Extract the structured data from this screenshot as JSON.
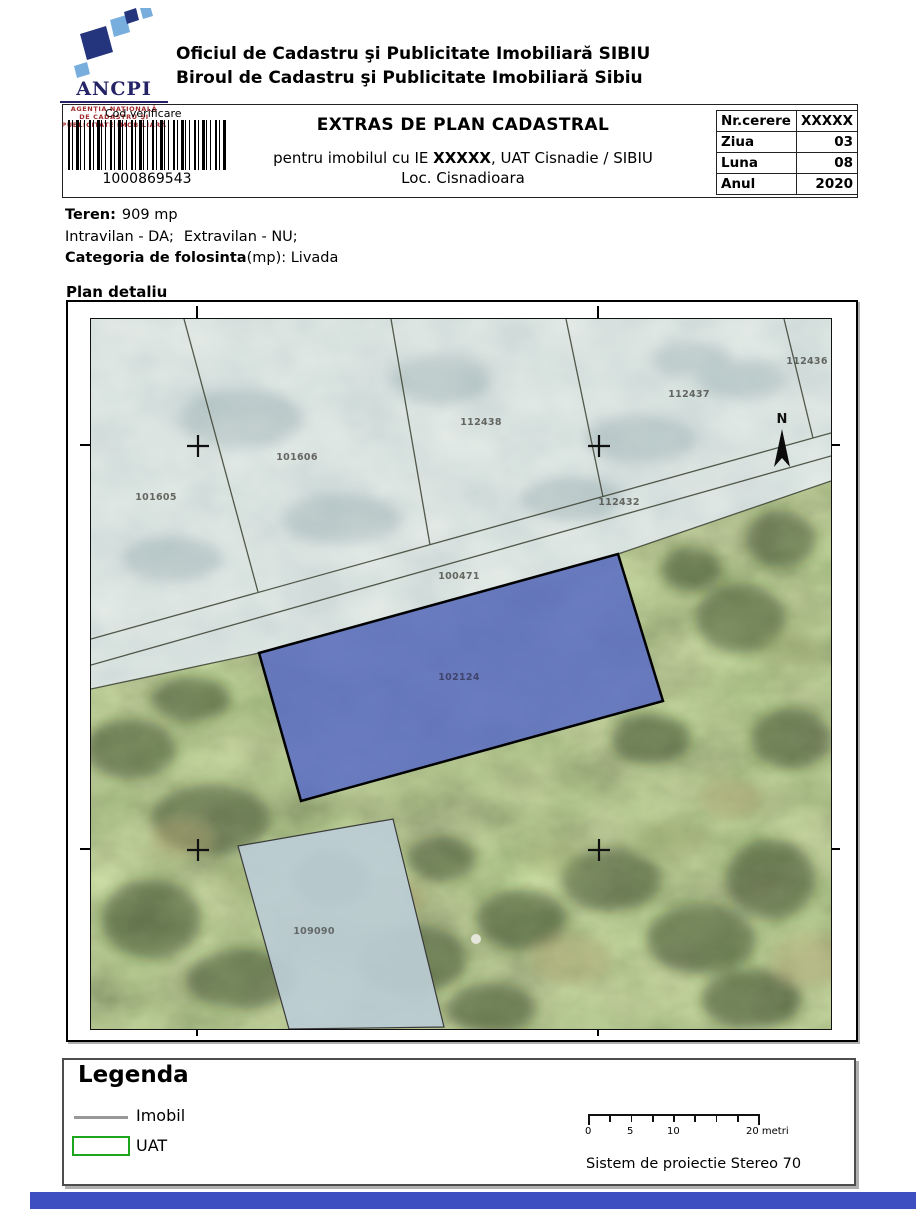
{
  "logo": {
    "acronym": "ANCPI",
    "line1": "AGENŢIA NAŢIONALĂ",
    "line2": "DE CADASTRU ŞI",
    "line3": "PUBLICITATE IMOBILIARĂ"
  },
  "header": {
    "line1": "Oficiul de Cadastru şi Publicitate Imobiliară SIBIU",
    "line2": "Biroul de Cadastru şi Publicitate Imobiliară Sibiu"
  },
  "verification": {
    "label": "Cod verificare",
    "code": "1000869543"
  },
  "title": {
    "main": "EXTRAS DE PLAN CADASTRAL",
    "sub_prefix": "pentru imobilul cu IE ",
    "sub_ie": "XXXXX",
    "sub_suffix": ", UAT Cisnadie / SIBIU",
    "sub_line2": "Loc. Cisnadioara"
  },
  "request_table": {
    "rows": [
      {
        "label": "Nr.cerere",
        "value": "XXXXX"
      },
      {
        "label": "Ziua",
        "value": "03"
      },
      {
        "label": "Luna",
        "value": "08"
      },
      {
        "label": "Anul",
        "value": "2020"
      }
    ]
  },
  "teren": {
    "label": "Teren:",
    "value": "909 mp",
    "intravilan": "Intravilan - DA;",
    "extravilan": "Extravilan - NU;",
    "cat_label": "Categoria de folosinta",
    "cat_rest": "(mp): Livada"
  },
  "map": {
    "title": "Plan detaliu",
    "north": "N",
    "parcels": [
      {
        "id": "101605"
      },
      {
        "id": "101606"
      },
      {
        "id": "112438"
      },
      {
        "id": "112437"
      },
      {
        "id": "112436"
      },
      {
        "id": "112432"
      },
      {
        "id": "100471"
      },
      {
        "id": "102124"
      },
      {
        "id": "109090"
      }
    ]
  },
  "legend": {
    "title": "Legenda",
    "imobil": "Imobil",
    "uat": "UAT",
    "scale_labels": {
      "l0": "0",
      "l5": "5",
      "l10": "10",
      "l20": "20 metri"
    },
    "projection": "Sistem de proiectie Stereo 70"
  },
  "colors": {
    "highlight_parcel": "#5a6cc5",
    "uat_green": "#1ea51e",
    "imobil_gray": "#999999",
    "footer_bar": "#3d4fc1",
    "logo_dark_blue": "#24357e",
    "logo_light_blue": "#77aedd",
    "logo_red": "#a22b2b"
  }
}
